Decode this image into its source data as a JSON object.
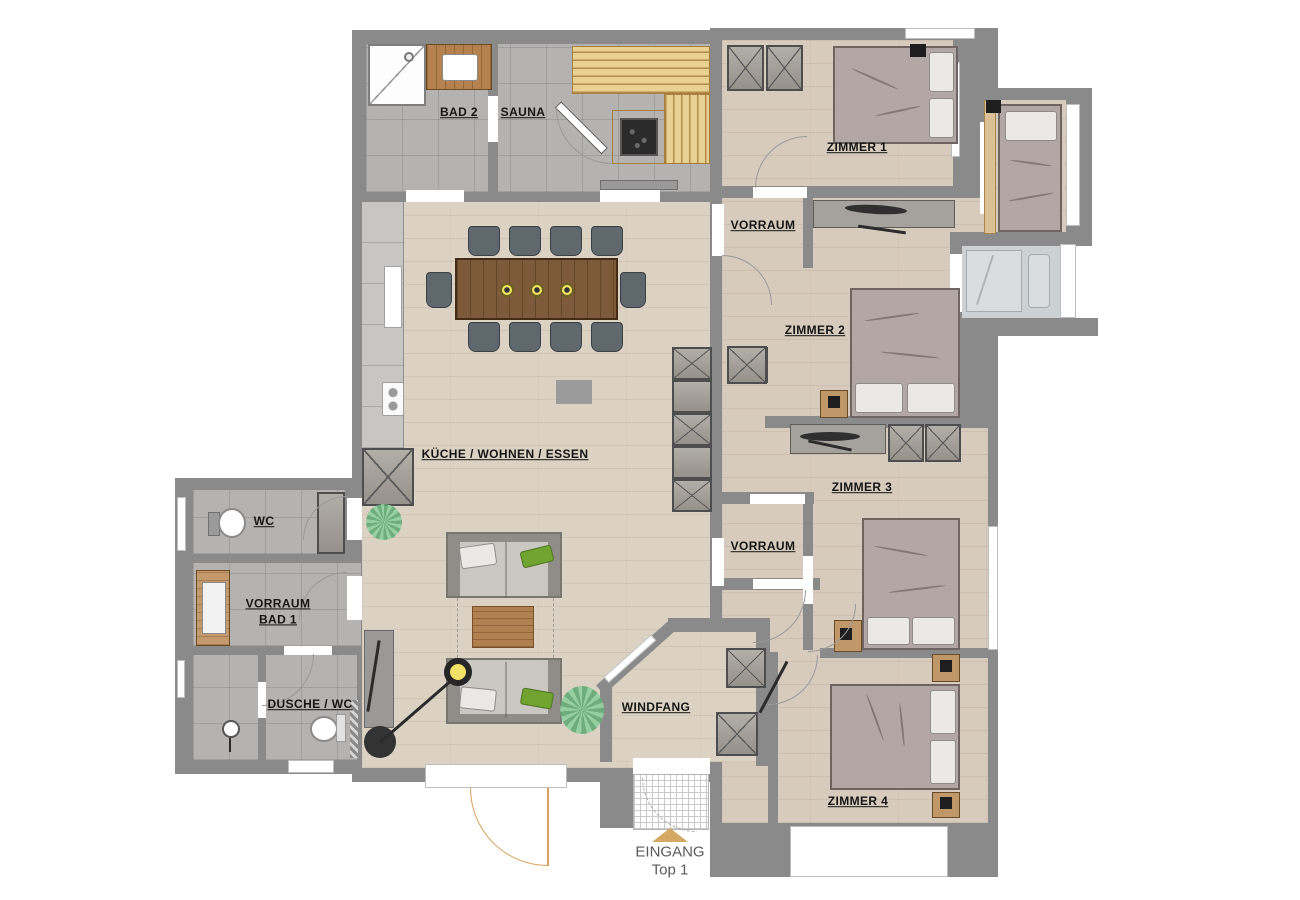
{
  "labels": {
    "bad2": "BAD 2",
    "sauna": "SAUNA",
    "zimmer1": "ZIMMER 1",
    "vorraum_top": "VORRAUM",
    "zimmer2": "ZIMMER 2",
    "zimmer3": "ZIMMER 3",
    "kueche": "KÜCHE / WOHNEN / ESSEN",
    "wc": "WC",
    "vorraum_bad1_line1": "VORRAUM",
    "vorraum_bad1_line2": "BAD 1",
    "dusche_wc": "DUSCHE / WC",
    "vorraum_bottom": "VORRAUM",
    "windfang": "WINDFANG",
    "zimmer4": "ZIMMER 4",
    "eingang_line1": "EINGANG",
    "eingang_line2": "Top 1"
  },
  "colors": {
    "wall": "#8a8a8a",
    "tile": "#b4b3b1",
    "wood": "#dcd2c4",
    "wood2": "#d7cbbe",
    "balcony": "#ccd1d4",
    "bench": "#e9d093",
    "benchline": "#b28c48",
    "mattress": "#b2a7a5",
    "pillow": "#ece8e5",
    "green": "#71a331",
    "light": "#f2e266",
    "accent": "#d9a05b",
    "accent2": "#d4a963",
    "label": "#151515",
    "entrance": "#5a5a5a",
    "table": "#7d5a39",
    "coffee": "#b08050"
  }
}
